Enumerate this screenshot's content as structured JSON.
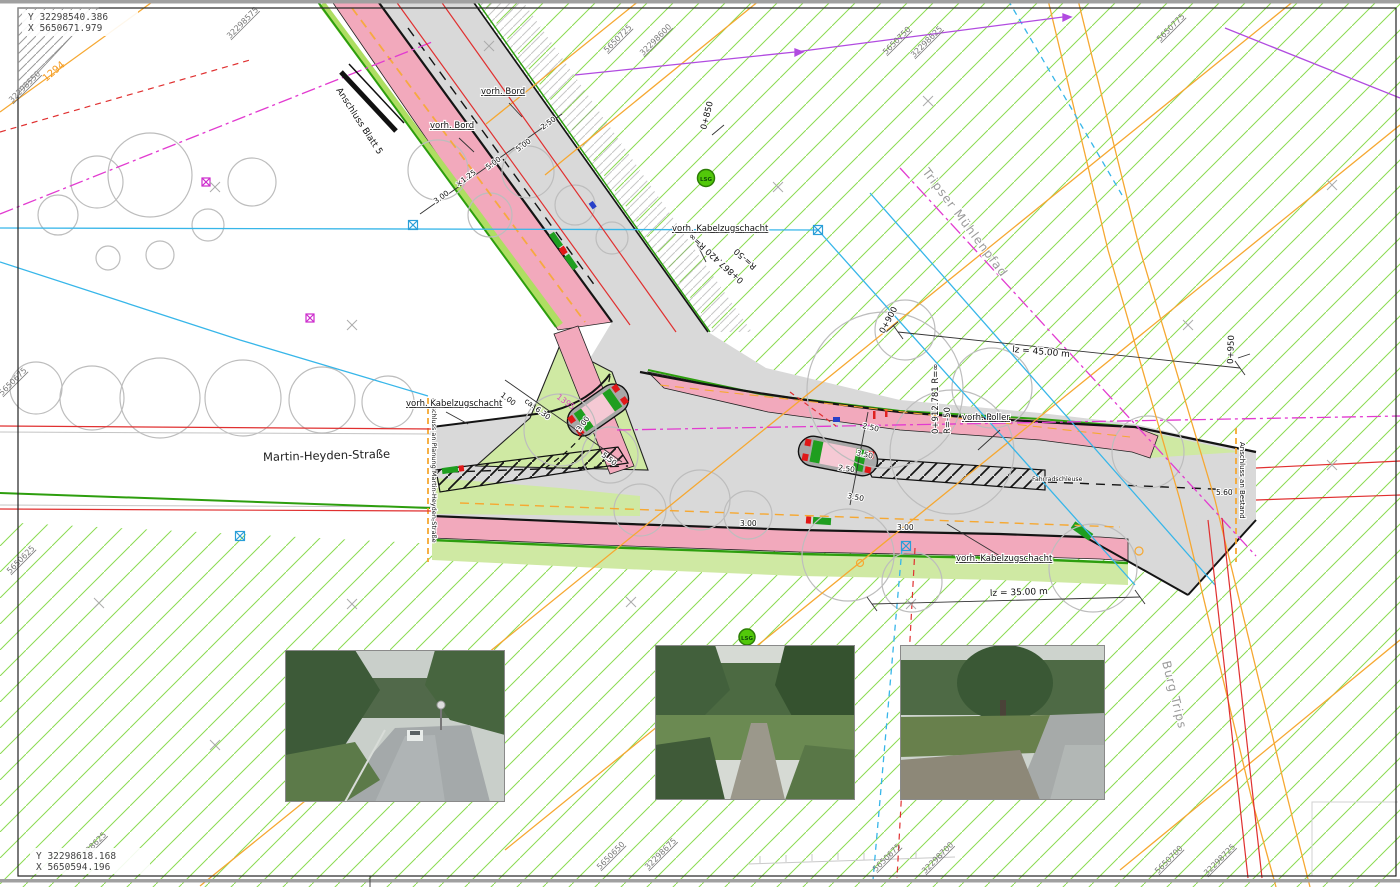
{
  "sheet": {
    "corner_top_y": "Y 32298540.386",
    "corner_top_x": "X 5650671.979",
    "corner_bottom_y": "Y 32298618.168",
    "corner_bottom_x": "X 5650594.196"
  },
  "grid": {
    "a": "32298575",
    "b": "32298550",
    "c": "5650725",
    "d": "32298600",
    "e": "5650750",
    "f": "32298625",
    "g": "5650775",
    "h": "5650675",
    "i": "5650625",
    "j": "32298625",
    "k": "5650650",
    "l": "32298675",
    "m": "5650675",
    "n": "32298700",
    "o": "5650700",
    "p": "32298725"
  },
  "streets": {
    "main": "Martin-Heyden-Straße",
    "muehlenpfad": "Tripser Mühlenpfad",
    "burg": "Burg Trips"
  },
  "connections": {
    "blatt5": "Anschluss Blatt 5",
    "planung": "Anschluss an Planung Martin-Heyden-Straße",
    "bestand": "Anschluss an Bestand"
  },
  "annotations": {
    "bord": "vorh. Bord",
    "kabel": "vorh. Kabelzugschacht",
    "poller": "vorh. Poller",
    "schleuse": "Fahrradschleuse"
  },
  "stations": {
    "s850": "0+850",
    "s900": "0+900",
    "s950": "0+950",
    "c867": "0+867.420 R=∞",
    "c867b": "R=-50",
    "c912": "0+912.781 R=∞",
    "c912b": "R=-50"
  },
  "dims": {
    "d250": "2.50",
    "d500": "5.00",
    "d300": "3.00",
    "d125": "×1.25",
    "d630": "ca. 6.30",
    "d550": "5.50",
    "d100": "1.00",
    "d350": "3.50",
    "d560": "5.60",
    "len45": "lz = 45.00 m",
    "len35": "lz = 35.00 m"
  },
  "markers": {
    "lsg": "LSG",
    "p1294": "1294",
    "p1395": "1395"
  },
  "colors": {
    "cycle_pink": "#f2a9bc",
    "asphalt": "#d9d9d9",
    "green_area": "#cfe9a3",
    "lsg_hatch": "#8bdb52",
    "utility_orange": "#f6a832",
    "utility_cyan": "#37b6e9",
    "boundary_magenta": "#e23bd0",
    "existing_red": "#e03030"
  }
}
